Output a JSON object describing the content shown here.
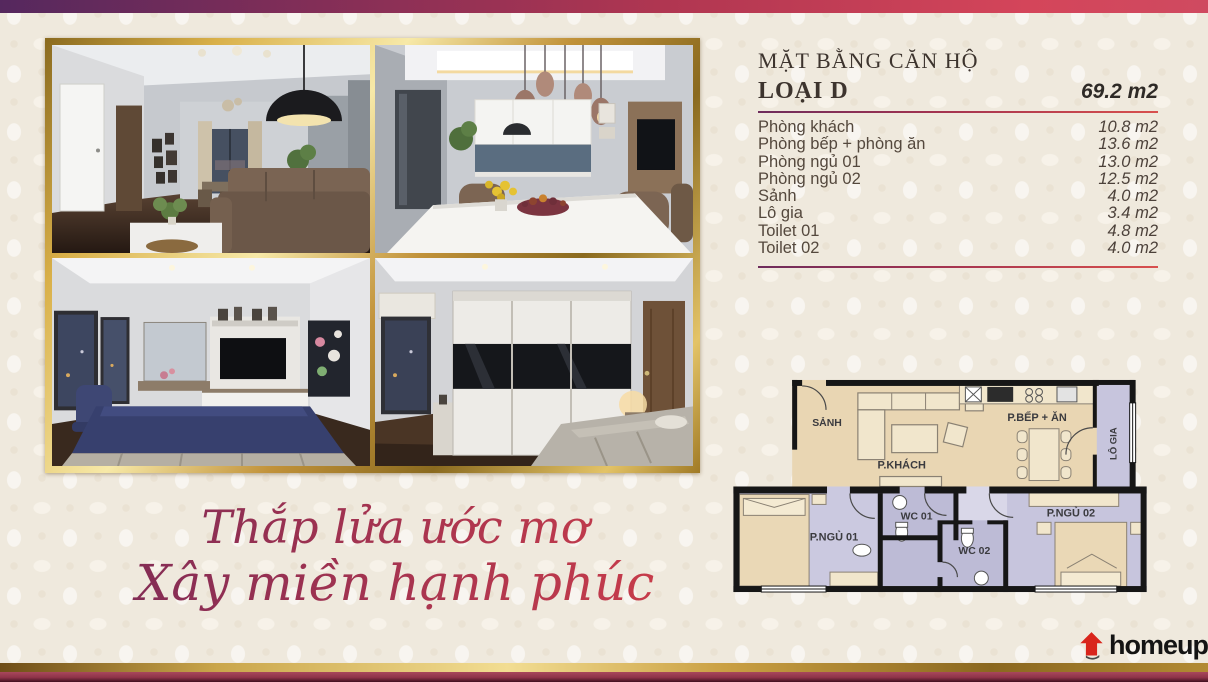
{
  "unit_info": {
    "section_title": "MẶT BẰNG CĂN HỘ",
    "type_label": "LOẠI D",
    "total_area": "69.2 m2",
    "rooms": [
      {
        "label": "Phòng khách",
        "area": "10.8 m2"
      },
      {
        "label": "Phòng bếp + phòng ăn",
        "area": "13.6 m2"
      },
      {
        "label": "Phòng ngủ 01",
        "area": "13.0 m2"
      },
      {
        "label": "Phòng ngủ 02",
        "area": "12.5 m2"
      },
      {
        "label": "Sảnh",
        "area": "4.0 m2"
      },
      {
        "label": "Lô gia",
        "area": "3.4 m2"
      },
      {
        "label": "Toilet 01",
        "area": "4.8 m2"
      },
      {
        "label": "Toilet 02",
        "area": "4.0 m2"
      }
    ]
  },
  "slogan": {
    "line1": "Thắp lửa ước mơ",
    "line2": "Xây miền hạnh phúc"
  },
  "floor_plan": {
    "hall": "SẢNH",
    "living_room": "P.KHÁCH",
    "kitchen_dining": "P.BẾP + ĂN",
    "loggia": "LÔ GIA",
    "bedroom_1": "P.NGỦ 01",
    "wc_1": "WC 01",
    "wc_2": "WC 02",
    "bedroom_2": "P.NGỦ 02"
  },
  "photos": {
    "top_left": "living-room-render",
    "top_right": "kitchen-dining-render",
    "bottom_left": "bedroom-1-render",
    "bottom_right": "bedroom-2-render"
  },
  "logo": {
    "brand": "homeup"
  },
  "colors": {
    "top_bar_start": "#55285e",
    "top_bar_end": "#d4455a",
    "accent_red": "#c83c4a",
    "gold": "#d9b049",
    "plan_tan": "#e9d6b3",
    "plan_lavender": "#c7c5dd",
    "background_cream": "#efe9dd",
    "logo_red": "#d9251c"
  }
}
